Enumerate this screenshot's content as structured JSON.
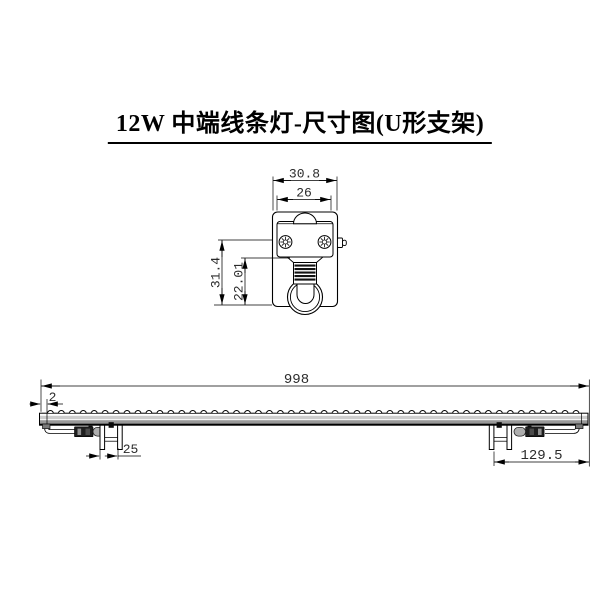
{
  "title": "12W 中端线条灯-尺寸图(U形支架)",
  "detail_view": {
    "dims": {
      "outer_width": "30.8",
      "inner_width": "26",
      "height": "31.4",
      "inner_height": "22.01"
    }
  },
  "side_view": {
    "dims": {
      "length": "998",
      "end_cap": "2",
      "bracket_gap": "25",
      "right_offset": "129.5"
    }
  },
  "colors": {
    "line": "#000000",
    "dim_text": "#2b2b2b",
    "band_light": "#cdcdcd",
    "band_dark": "#999999",
    "connector_dark": "#1e1e1e",
    "connector_cap": "#aeaeae",
    "fitting_gray": "#7a7a7a"
  }
}
